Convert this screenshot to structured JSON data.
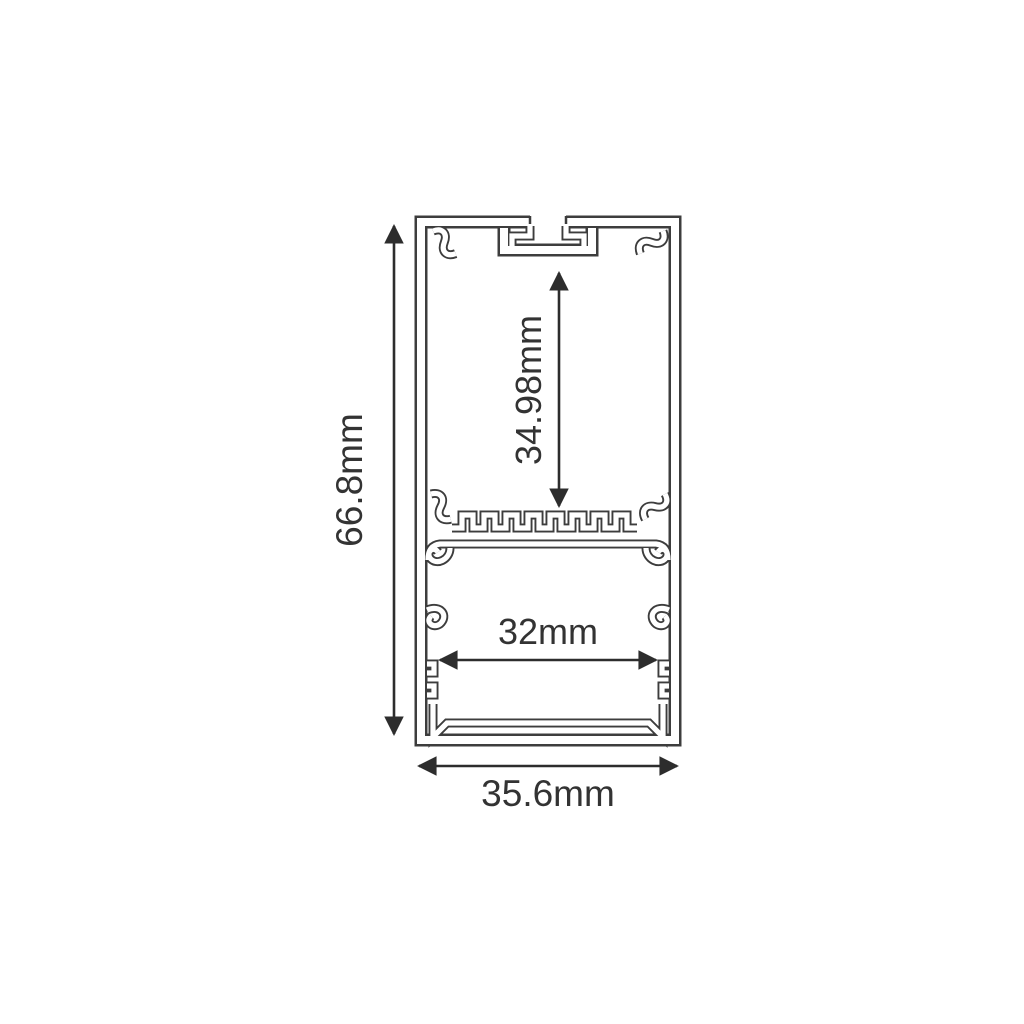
{
  "colors": {
    "background": "#ffffff",
    "line": "#3d3d3d",
    "dimension": "#2d2d2d",
    "text": "#333333"
  },
  "drawing": {
    "dimensions": {
      "overall_height": "66.8mm",
      "inner_height": "34.98mm",
      "inner_width": "32mm",
      "overall_width": "35.6mm"
    }
  }
}
